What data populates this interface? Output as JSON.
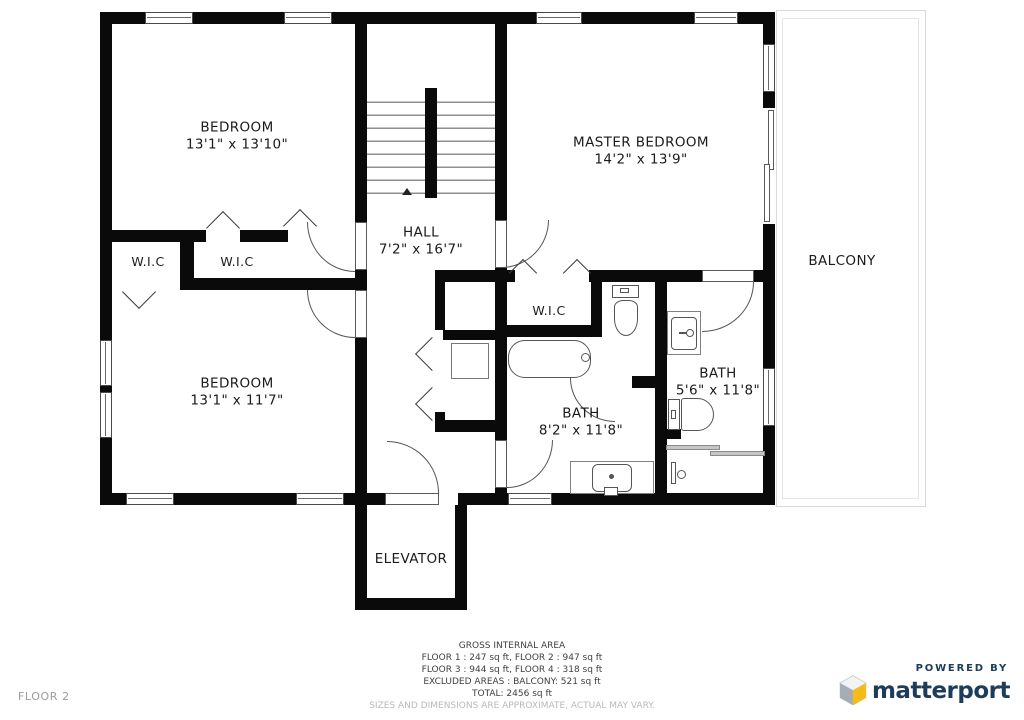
{
  "rooms": {
    "bedroom_tl": {
      "label": "BEDROOM",
      "dims": "13'1\" x 13'10\""
    },
    "master": {
      "label": "MASTER BEDROOM",
      "dims": "14'2\" x 13'9\""
    },
    "hall": {
      "label": "HALL",
      "dims": "7'2\" x 16'7\""
    },
    "wic_left_a": {
      "label": "W.I.C"
    },
    "wic_left_b": {
      "label": "W.I.C"
    },
    "wic_master": {
      "label": "W.I.C"
    },
    "bedroom_bl": {
      "label": "BEDROOM",
      "dims": "13'1\" x 11'7\""
    },
    "bath_main": {
      "label": "BATH",
      "dims": "8'2\" x 11'8\""
    },
    "bath_ensuite": {
      "label": "BATH",
      "dims": "5'6\" x 11'8\""
    },
    "balcony": {
      "label": "BALCONY"
    },
    "elevator": {
      "label": "ELEVATOR"
    }
  },
  "area_summary": {
    "title": "GROSS INTERNAL AREA",
    "line_floors_1_2": "FLOOR 1 : 247 sq ft, FLOOR 2 : 947 sq ft",
    "line_floors_3_4": "FLOOR 3 : 944 sq ft, FLOOR 4 : 318 sq ft",
    "line_excluded": "EXCLUDED AREAS : BALCONY: 521 sq ft",
    "line_total": "TOTAL: 2456 sq ft",
    "disclaimer": "SIZES AND DIMENSIONS ARE APPROXIMATE, ACTUAL MAY VARY."
  },
  "footer": {
    "floor_label": "FLOOR 2"
  },
  "branding": {
    "powered_by": "POWERED BY",
    "brand_name": "matterport"
  },
  "colors": {
    "wall": "#0a0a0a",
    "brand_navy": "#1d3c5c",
    "brand_yellow": "#f3bc1b",
    "brand_gray": "#a7adb5"
  }
}
